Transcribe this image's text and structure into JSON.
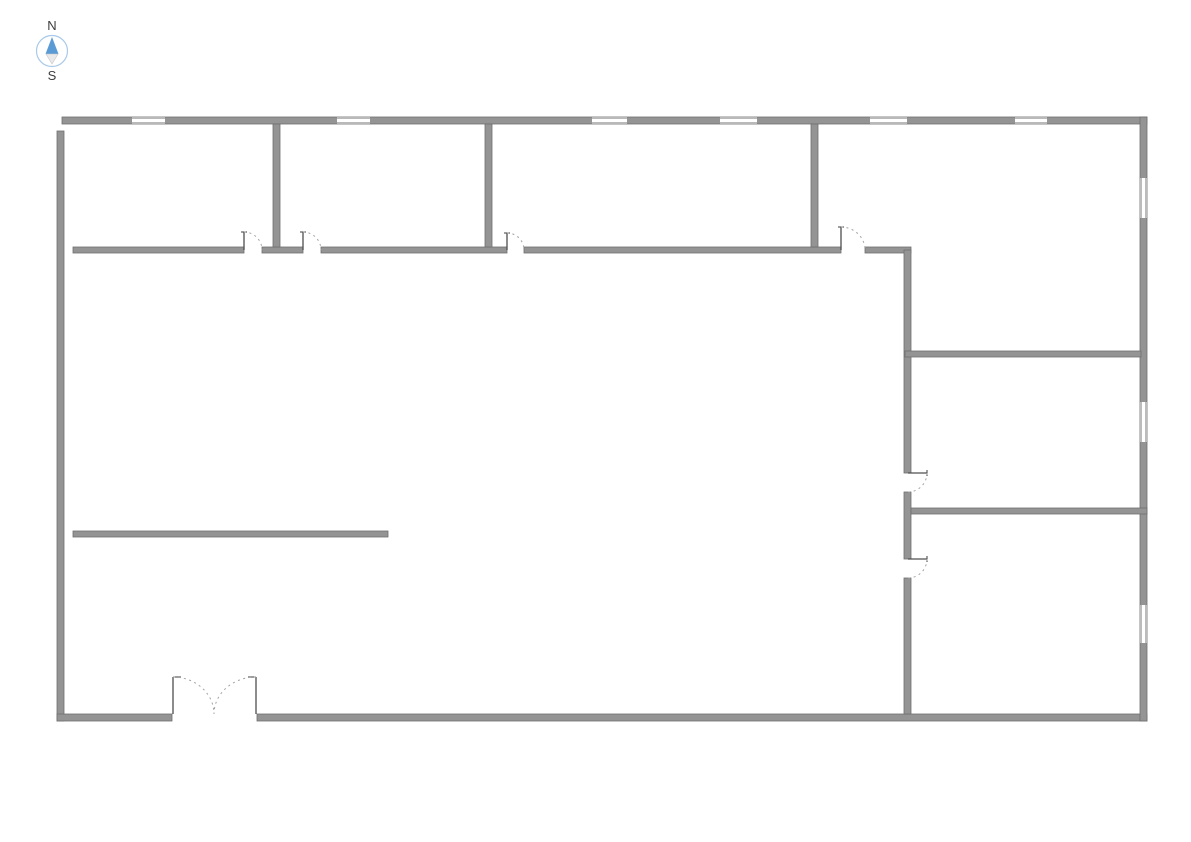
{
  "page": {
    "background": "#ffffff"
  },
  "compass": {
    "north_label": "N",
    "south_label": "S",
    "ring_color": "#a9c9e9",
    "north_color": "#5b9bd5",
    "south_color": "#e9e9e9",
    "label_color": "#3d3d3d"
  },
  "floorplan": {
    "colors": {
      "wall_fill": "#949494",
      "wall_edge": "#6f6f6f",
      "window_fill": "#ffffff",
      "window_line": "#8f8f8f",
      "door_leaf": "#4f4f4f",
      "door_arc": "#a3a3a3"
    },
    "walls": [
      {
        "name": "exterior-wall-north",
        "x": 62,
        "y": 117,
        "w": 1085,
        "h": 7
      },
      {
        "name": "exterior-wall-west",
        "x": 57,
        "y": 131,
        "w": 7,
        "h": 590
      },
      {
        "name": "exterior-wall-south-left",
        "x": 57,
        "y": 714,
        "w": 115,
        "h": 7
      },
      {
        "name": "exterior-wall-south-right",
        "x": 257,
        "y": 714,
        "w": 890,
        "h": 7
      },
      {
        "name": "exterior-wall-east",
        "x": 1140,
        "y": 117,
        "w": 7,
        "h": 604
      },
      {
        "name": "interior-wall-upper-seg-1",
        "x": 73,
        "y": 247,
        "w": 171,
        "h": 6
      },
      {
        "name": "interior-wall-upper-seg-2",
        "x": 262,
        "y": 247,
        "w": 41,
        "h": 6
      },
      {
        "name": "interior-wall-upper-seg-3",
        "x": 321,
        "y": 247,
        "w": 186,
        "h": 6
      },
      {
        "name": "interior-wall-upper-seg-4",
        "x": 524,
        "y": 247,
        "w": 317,
        "h": 6
      },
      {
        "name": "interior-wall-upper-seg-5",
        "x": 865,
        "y": 247,
        "w": 46,
        "h": 6
      },
      {
        "name": "interior-wall-divider-1",
        "x": 273,
        "y": 124,
        "w": 7,
        "h": 123
      },
      {
        "name": "interior-wall-divider-2",
        "x": 485,
        "y": 124,
        "w": 7,
        "h": 123
      },
      {
        "name": "interior-wall-divider-3",
        "x": 811,
        "y": 124,
        "w": 7,
        "h": 123
      },
      {
        "name": "interior-wall-east-seg-1",
        "x": 904,
        "y": 250,
        "w": 7,
        "h": 223
      },
      {
        "name": "interior-wall-east-seg-2",
        "x": 904,
        "y": 492,
        "w": 7,
        "h": 67
      },
      {
        "name": "interior-wall-east-seg-3",
        "x": 904,
        "y": 578,
        "w": 7,
        "h": 136
      },
      {
        "name": "interior-wall-right-h1",
        "x": 905,
        "y": 351,
        "w": 236,
        "h": 6
      },
      {
        "name": "interior-wall-right-h2",
        "x": 911,
        "y": 508,
        "w": 236,
        "h": 6
      },
      {
        "name": "interior-wall-partial",
        "x": 73,
        "y": 531,
        "w": 315,
        "h": 6
      }
    ],
    "windows": [
      {
        "name": "window-north-1",
        "x": 132,
        "y": 117,
        "w": 33,
        "h": 7,
        "dir": "h"
      },
      {
        "name": "window-north-2",
        "x": 337,
        "y": 117,
        "w": 33,
        "h": 7,
        "dir": "h"
      },
      {
        "name": "window-north-3",
        "x": 592,
        "y": 117,
        "w": 35,
        "h": 7,
        "dir": "h"
      },
      {
        "name": "window-north-4",
        "x": 720,
        "y": 117,
        "w": 37,
        "h": 7,
        "dir": "h"
      },
      {
        "name": "window-north-5",
        "x": 870,
        "y": 117,
        "w": 37,
        "h": 7,
        "dir": "h"
      },
      {
        "name": "window-north-6",
        "x": 1015,
        "y": 117,
        "w": 32,
        "h": 7,
        "dir": "h"
      },
      {
        "name": "window-east-1",
        "x": 1140,
        "y": 178,
        "w": 7,
        "h": 40,
        "dir": "v"
      },
      {
        "name": "window-east-2",
        "x": 1140,
        "y": 402,
        "w": 7,
        "h": 40,
        "dir": "v"
      },
      {
        "name": "window-east-3",
        "x": 1140,
        "y": 605,
        "w": 7,
        "h": 38,
        "dir": "v"
      }
    ],
    "doors": [
      {
        "name": "door-room1",
        "leaf": [
          244,
          232,
          244,
          250
        ],
        "tick": [
          241,
          232,
          247,
          232
        ],
        "arc": {
          "from": [
            244,
            232
          ],
          "to": [
            262,
            250
          ],
          "rx": 18,
          "ry": 18,
          "sweep": 1
        }
      },
      {
        "name": "door-room2",
        "leaf": [
          303,
          232,
          303,
          250
        ],
        "tick": [
          300,
          232,
          306,
          232
        ],
        "arc": {
          "from": [
            303,
            232
          ],
          "to": [
            321,
            250
          ],
          "rx": 18,
          "ry": 18,
          "sweep": 1
        }
      },
      {
        "name": "door-room3",
        "leaf": [
          507,
          233,
          507,
          250
        ],
        "tick": [
          504,
          233,
          510,
          233
        ],
        "arc": {
          "from": [
            507,
            233
          ],
          "to": [
            524,
            250
          ],
          "rx": 17,
          "ry": 17,
          "sweep": 1
        }
      },
      {
        "name": "door-room4",
        "leaf": [
          841,
          227,
          841,
          250
        ],
        "tick": [
          838,
          227,
          844,
          227
        ],
        "arc": {
          "from": [
            841,
            227
          ],
          "to": [
            865,
            250
          ],
          "rx": 24,
          "ry": 23,
          "sweep": 1
        }
      },
      {
        "name": "door-right-room-upper",
        "leaf": [
          908,
          473,
          927,
          473
        ],
        "tick": [
          927,
          470,
          927,
          476
        ],
        "arc": {
          "from": [
            927,
            473
          ],
          "to": [
            908,
            492
          ],
          "rx": 19,
          "ry": 19,
          "sweep": 1
        }
      },
      {
        "name": "door-right-room-lower",
        "leaf": [
          908,
          559,
          927,
          559
        ],
        "tick": [
          927,
          556,
          927,
          562
        ],
        "arc": {
          "from": [
            927,
            559
          ],
          "to": [
            908,
            578
          ],
          "rx": 19,
          "ry": 19,
          "sweep": 1
        }
      },
      {
        "name": "entry-double-door-left",
        "leaf": [
          173,
          677,
          173,
          714
        ],
        "tick": [
          173,
          677,
          181,
          677
        ],
        "arc": {
          "from": [
            173,
            677
          ],
          "to": [
            214,
            714
          ],
          "rx": 41,
          "ry": 37,
          "sweep": 1
        }
      },
      {
        "name": "entry-double-door-right",
        "leaf": [
          256,
          677,
          256,
          714
        ],
        "tick": [
          248,
          677,
          256,
          677
        ],
        "arc": {
          "from": [
            256,
            677
          ],
          "to": [
            214,
            714
          ],
          "rx": 42,
          "ry": 37,
          "sweep": 0
        }
      }
    ]
  }
}
